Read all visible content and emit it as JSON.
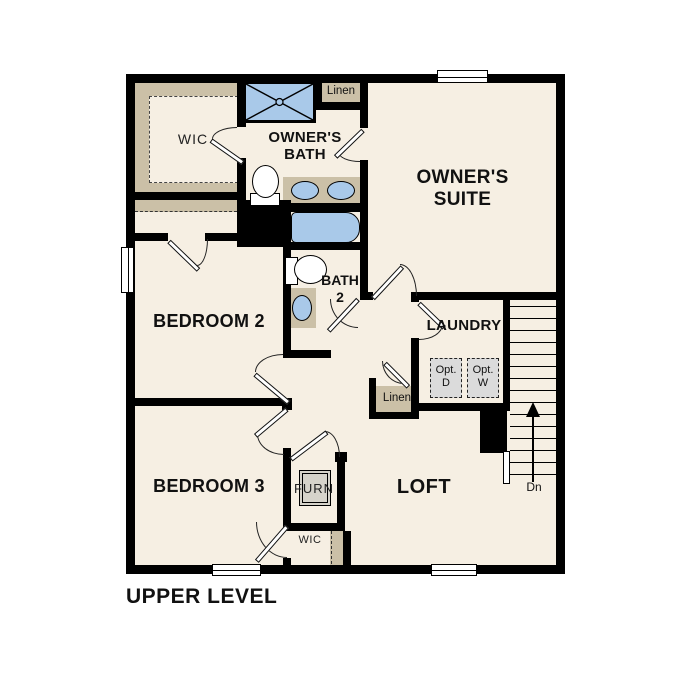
{
  "title": "UPPER LEVEL",
  "colors": {
    "floor": "#f6efe3",
    "wall": "#000000",
    "cabinet_tan": "#cbc0a7",
    "fixture_blue": "#a9c9e9",
    "appliance_gray": "#dbdbdb"
  },
  "rooms": {
    "wic_upper": {
      "label": "WIC"
    },
    "owners_bath": {
      "label": "OWNER'S BATH"
    },
    "owners_suite": {
      "label": "OWNER'S SUITE"
    },
    "bedroom2": {
      "label": "BEDROOM 2"
    },
    "bath2": {
      "label_line1": "BATH",
      "label_line2": "2"
    },
    "laundry": {
      "label": "LAUNDRY"
    },
    "bedroom3": {
      "label": "BEDROOM 3"
    },
    "loft": {
      "label": "LOFT"
    },
    "wic_lower": {
      "label": "WIC"
    },
    "furnace_closet": {
      "label": "FURN"
    }
  },
  "closets": {
    "linen_upper": {
      "label": "Linen"
    },
    "linen_hall": {
      "label": "Linen"
    }
  },
  "appliances": {
    "optional_dryer": {
      "line1": "Opt.",
      "line2": "D"
    },
    "optional_washer": {
      "line1": "Opt.",
      "line2": "W"
    }
  },
  "stairs": {
    "direction_label": "Dn"
  }
}
